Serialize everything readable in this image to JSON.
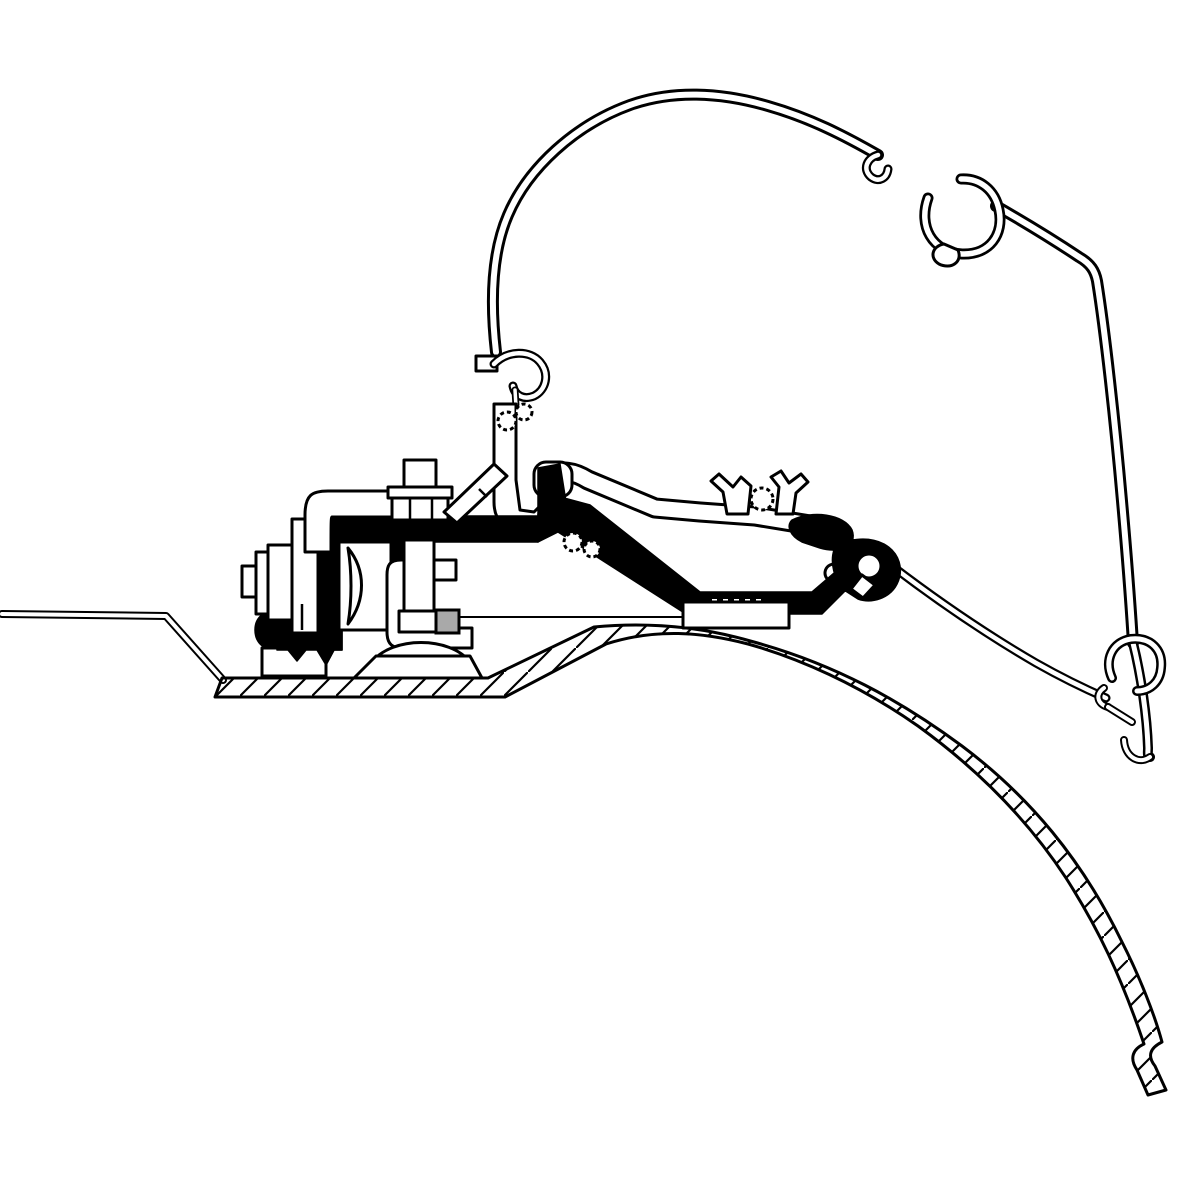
{
  "canvas": {
    "width": 1200,
    "height": 1200
  },
  "colors": {
    "paper": "#ffffff",
    "ink": "#000000",
    "shade": "#a9a9a9"
  },
  "figure": {
    "type": "technical-cross-section-line-drawing"
  },
  "parts": [
    "awning-case-shell",
    "case-fabric-clip",
    "case-lower-channel",
    "case-front-lip",
    "case-mounting-leg",
    "case-skirt",
    "adapter-rail",
    "adapter-extrusion",
    "mounting-bracket-plate",
    "clamp-bolt",
    "hex-nut",
    "vertical-bolt",
    "clamp-claw",
    "support-dome",
    "support-pedestal",
    "diagonal-strut",
    "vehicle-roof-panel"
  ]
}
